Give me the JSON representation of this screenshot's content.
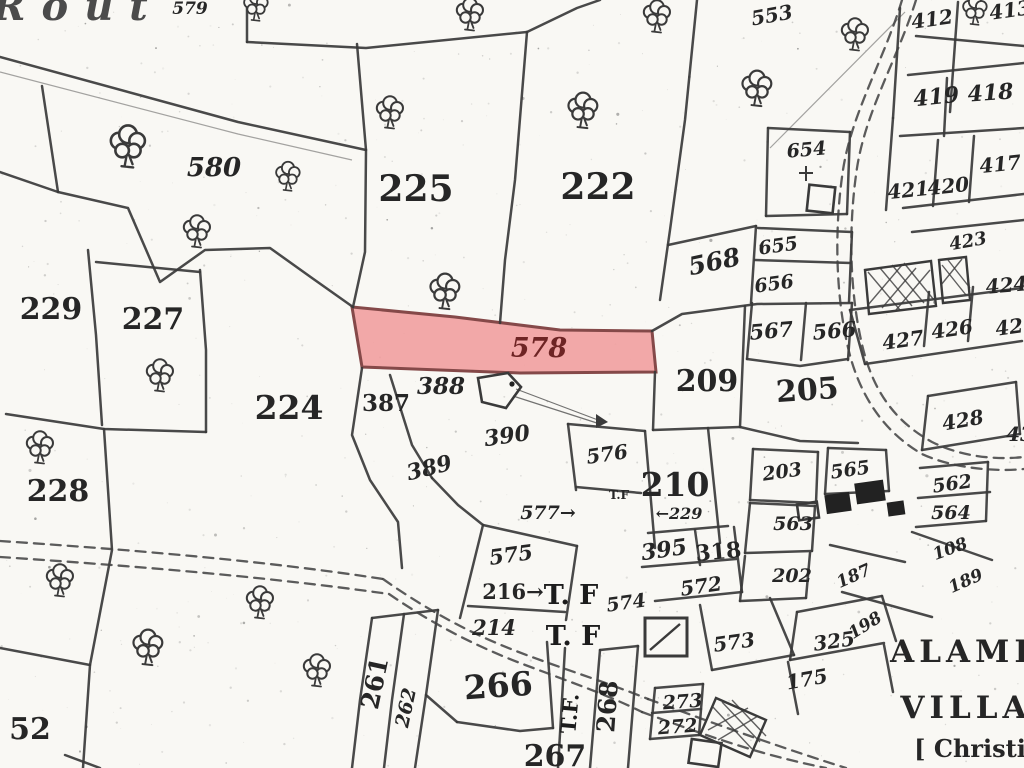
{
  "map": {
    "kind": "scanned cadastral parcel map",
    "paper_color": "#f9f8f4",
    "ink_color": "#3a3a3a",
    "label_color": "#262626",
    "highlight": {
      "parcel": "578",
      "fill": "#f2a2a2",
      "stroke": "#7c3b3b",
      "label_color": "#6e2424",
      "points": "352,307 455,317 560,330 652,331 656,372 520,373 362,367"
    },
    "corner_text_fragment": "Rout",
    "village_text": [
      "ALAMI",
      "VILLA",
      "[ Christi"
    ],
    "labels": [
      {
        "t": "Rout",
        "x": 78,
        "y": 20,
        "s": 40,
        "i": 1,
        "ls": 16,
        "c": "#4b4b4b"
      },
      {
        "t": "579",
        "x": 190,
        "y": 14,
        "s": 17,
        "i": 1
      },
      {
        "t": "580",
        "x": 214,
        "y": 176,
        "s": 26,
        "i": 1
      },
      {
        "t": "225",
        "x": 416,
        "y": 201,
        "s": 36,
        "w": 700
      },
      {
        "t": "222",
        "x": 598,
        "y": 199,
        "s": 36,
        "w": 700
      },
      {
        "t": "553",
        "x": 773,
        "y": 22,
        "s": 20,
        "i": 1,
        "r": -10
      },
      {
        "t": "654",
        "x": 807,
        "y": 156,
        "s": 19,
        "i": 1,
        "r": -5
      },
      {
        "t": "412",
        "x": 933,
        "y": 26,
        "s": 20,
        "i": 1,
        "r": -8
      },
      {
        "t": "413",
        "x": 1011,
        "y": 17,
        "s": 20,
        "i": 1,
        "r": -8
      },
      {
        "t": "419",
        "x": 937,
        "y": 104,
        "s": 22,
        "i": 1,
        "r": -6
      },
      {
        "t": "418",
        "x": 991,
        "y": 100,
        "s": 22,
        "i": 1,
        "r": -4
      },
      {
        "t": "417",
        "x": 1001,
        "y": 171,
        "s": 20,
        "i": 1,
        "r": -6
      },
      {
        "t": "421",
        "x": 909,
        "y": 197,
        "s": 20,
        "i": 1,
        "r": -6
      },
      {
        "t": "420",
        "x": 949,
        "y": 193,
        "s": 20,
        "i": 1,
        "r": -6
      },
      {
        "t": "423",
        "x": 969,
        "y": 247,
        "s": 18,
        "i": 1,
        "r": -10
      },
      {
        "t": "424",
        "x": 1007,
        "y": 292,
        "s": 20,
        "i": 1,
        "r": -5
      },
      {
        "t": "427",
        "x": 904,
        "y": 347,
        "s": 20,
        "i": 1,
        "r": -8
      },
      {
        "t": "426",
        "x": 953,
        "y": 336,
        "s": 20,
        "i": 1,
        "r": -8
      },
      {
        "t": "425",
        "x": 1017,
        "y": 333,
        "s": 20,
        "i": 1,
        "r": -8
      },
      {
        "t": "428",
        "x": 964,
        "y": 427,
        "s": 20,
        "i": 1,
        "r": -10
      },
      {
        "t": "43",
        "x": 1020,
        "y": 441,
        "s": 20,
        "i": 1
      },
      {
        "t": "229",
        "x": 51,
        "y": 319,
        "s": 30,
        "w": 700
      },
      {
        "t": "227",
        "x": 153,
        "y": 329,
        "s": 30,
        "w": 700
      },
      {
        "t": "224",
        "x": 289,
        "y": 419,
        "s": 33,
        "w": 700
      },
      {
        "t": "228",
        "x": 58,
        "y": 501,
        "s": 30,
        "w": 700
      },
      {
        "t": "52",
        "x": 30,
        "y": 739,
        "s": 30,
        "w": 700
      },
      {
        "t": "578",
        "x": 539,
        "y": 357,
        "s": 27,
        "i": 1,
        "c": "#6e2424"
      },
      {
        "t": "388",
        "x": 441,
        "y": 394,
        "s": 23,
        "i": 1,
        "w": 700
      },
      {
        "t": "387",
        "x": 386,
        "y": 411,
        "s": 23,
        "w": 700
      },
      {
        "t": "390",
        "x": 508,
        "y": 443,
        "s": 22,
        "i": 1,
        "r": -8
      },
      {
        "t": "389",
        "x": 431,
        "y": 475,
        "s": 22,
        "i": 1,
        "r": -14
      },
      {
        "t": "209",
        "x": 707,
        "y": 391,
        "s": 30,
        "w": 700
      },
      {
        "t": "205",
        "x": 808,
        "y": 400,
        "s": 30,
        "w": 700,
        "r": -4
      },
      {
        "t": "568",
        "x": 716,
        "y": 270,
        "s": 25,
        "i": 1,
        "r": -12
      },
      {
        "t": "655",
        "x": 779,
        "y": 252,
        "s": 19,
        "i": 1,
        "r": -8
      },
      {
        "t": "656",
        "x": 775,
        "y": 290,
        "s": 19,
        "i": 1,
        "r": -8
      },
      {
        "t": "567",
        "x": 772,
        "y": 338,
        "s": 21,
        "i": 1,
        "r": -5
      },
      {
        "t": "566",
        "x": 835,
        "y": 338,
        "s": 21,
        "i": 1,
        "r": -5
      },
      {
        "t": "576",
        "x": 608,
        "y": 461,
        "s": 20,
        "i": 1,
        "r": -8
      },
      {
        "t": "T.F",
        "x": 619,
        "y": 499,
        "s": 12,
        "w": 700
      },
      {
        "t": "577→",
        "x": 548,
        "y": 519,
        "s": 19,
        "i": 1
      },
      {
        "t": "210",
        "x": 675,
        "y": 496,
        "s": 33,
        "w": 700
      },
      {
        "t": "←229",
        "x": 679,
        "y": 519,
        "s": 16,
        "i": 1
      },
      {
        "t": "395",
        "x": 665,
        "y": 557,
        "s": 22,
        "i": 1,
        "r": -8,
        "w": 700
      },
      {
        "t": "318",
        "x": 719,
        "y": 559,
        "s": 22,
        "r": -5,
        "w": 700
      },
      {
        "t": "572",
        "x": 702,
        "y": 593,
        "s": 20,
        "i": 1,
        "r": -8
      },
      {
        "t": "573",
        "x": 735,
        "y": 649,
        "s": 20,
        "i": 1,
        "r": -8
      },
      {
        "t": "575",
        "x": 512,
        "y": 562,
        "s": 21,
        "i": 1,
        "r": -8
      },
      {
        "t": "216→",
        "x": 513,
        "y": 599,
        "s": 21,
        "w": 700
      },
      {
        "t": "214",
        "x": 494,
        "y": 635,
        "s": 21,
        "i": 1
      },
      {
        "t": "574",
        "x": 627,
        "y": 609,
        "s": 19,
        "i": 1,
        "r": -8
      },
      {
        "t": "T. F",
        "x": 571,
        "y": 604,
        "s": 27,
        "w": 800,
        "c": "#1c1c1c"
      },
      {
        "t": "T. F",
        "x": 573,
        "y": 645,
        "s": 27,
        "w": 800,
        "c": "#1c1c1c"
      },
      {
        "t": "T.F.",
        "x": 577,
        "y": 714,
        "s": 21,
        "w": 800,
        "r": -85,
        "c": "#1c1c1c"
      },
      {
        "t": "203",
        "x": 783,
        "y": 478,
        "s": 19,
        "i": 1,
        "r": -8
      },
      {
        "t": "565",
        "x": 851,
        "y": 476,
        "s": 19,
        "i": 1,
        "r": -8
      },
      {
        "t": "563",
        "x": 793,
        "y": 530,
        "s": 19,
        "i": 1
      },
      {
        "t": "562",
        "x": 953,
        "y": 490,
        "s": 19,
        "i": 1,
        "r": -8
      },
      {
        "t": "564",
        "x": 951,
        "y": 519,
        "s": 19,
        "i": 1
      },
      {
        "t": "202",
        "x": 792,
        "y": 582,
        "s": 19,
        "i": 1
      },
      {
        "t": "108",
        "x": 952,
        "y": 554,
        "s": 17,
        "i": 1,
        "r": -20
      },
      {
        "t": "187",
        "x": 856,
        "y": 581,
        "s": 17,
        "i": 1,
        "r": -24
      },
      {
        "t": "189",
        "x": 968,
        "y": 586,
        "s": 17,
        "i": 1,
        "r": -24
      },
      {
        "t": "198",
        "x": 868,
        "y": 630,
        "s": 17,
        "i": 1,
        "r": -32
      },
      {
        "t": "325",
        "x": 835,
        "y": 648,
        "s": 20,
        "i": 1,
        "r": -8
      },
      {
        "t": "175",
        "x": 808,
        "y": 686,
        "s": 20,
        "i": 1,
        "r": -10
      },
      {
        "t": "261",
        "x": 383,
        "y": 685,
        "s": 25,
        "w": 700,
        "r": -78
      },
      {
        "t": "262",
        "x": 412,
        "y": 709,
        "s": 19,
        "i": 1,
        "r": -78
      },
      {
        "t": "266",
        "x": 499,
        "y": 697,
        "s": 33,
        "w": 700,
        "r": -4
      },
      {
        "t": "267",
        "x": 555,
        "y": 766,
        "s": 30,
        "w": 700
      },
      {
        "t": "268",
        "x": 616,
        "y": 707,
        "s": 25,
        "w": 700,
        "r": -86
      },
      {
        "t": "273",
        "x": 683,
        "y": 708,
        "s": 19,
        "i": 1,
        "r": -4
      },
      {
        "t": "272",
        "x": 678,
        "y": 733,
        "s": 19,
        "i": 1,
        "r": -4
      },
      {
        "t": "ALAMI",
        "x": 962,
        "y": 662,
        "s": 31,
        "w": 700,
        "ls": 5
      },
      {
        "t": "VILLA",
        "x": 966,
        "y": 718,
        "s": 31,
        "w": 700,
        "ls": 5
      },
      {
        "t": "[ Christi",
        "x": 970,
        "y": 757,
        "s": 24,
        "w": 600
      }
    ],
    "trees": [
      {
        "x": 128,
        "y": 146,
        "s": 1.3
      },
      {
        "x": 288,
        "y": 176,
        "s": 0.9
      },
      {
        "x": 197,
        "y": 231,
        "s": 1.0
      },
      {
        "x": 390,
        "y": 112,
        "s": 1.0
      },
      {
        "x": 445,
        "y": 291,
        "s": 1.1
      },
      {
        "x": 583,
        "y": 110,
        "s": 1.1
      },
      {
        "x": 470,
        "y": 14,
        "s": 1.0
      },
      {
        "x": 657,
        "y": 16,
        "s": 1.0
      },
      {
        "x": 757,
        "y": 88,
        "s": 1.1
      },
      {
        "x": 855,
        "y": 34,
        "s": 1.0
      },
      {
        "x": 975,
        "y": 10,
        "s": 0.9
      },
      {
        "x": 160,
        "y": 375,
        "s": 1.0
      },
      {
        "x": 40,
        "y": 447,
        "s": 1.0
      },
      {
        "x": 60,
        "y": 580,
        "s": 1.0
      },
      {
        "x": 148,
        "y": 647,
        "s": 1.1
      },
      {
        "x": 260,
        "y": 602,
        "s": 1.0
      },
      {
        "x": 317,
        "y": 670,
        "s": 1.0
      },
      {
        "x": 256,
        "y": 6,
        "s": 0.9
      }
    ]
  }
}
